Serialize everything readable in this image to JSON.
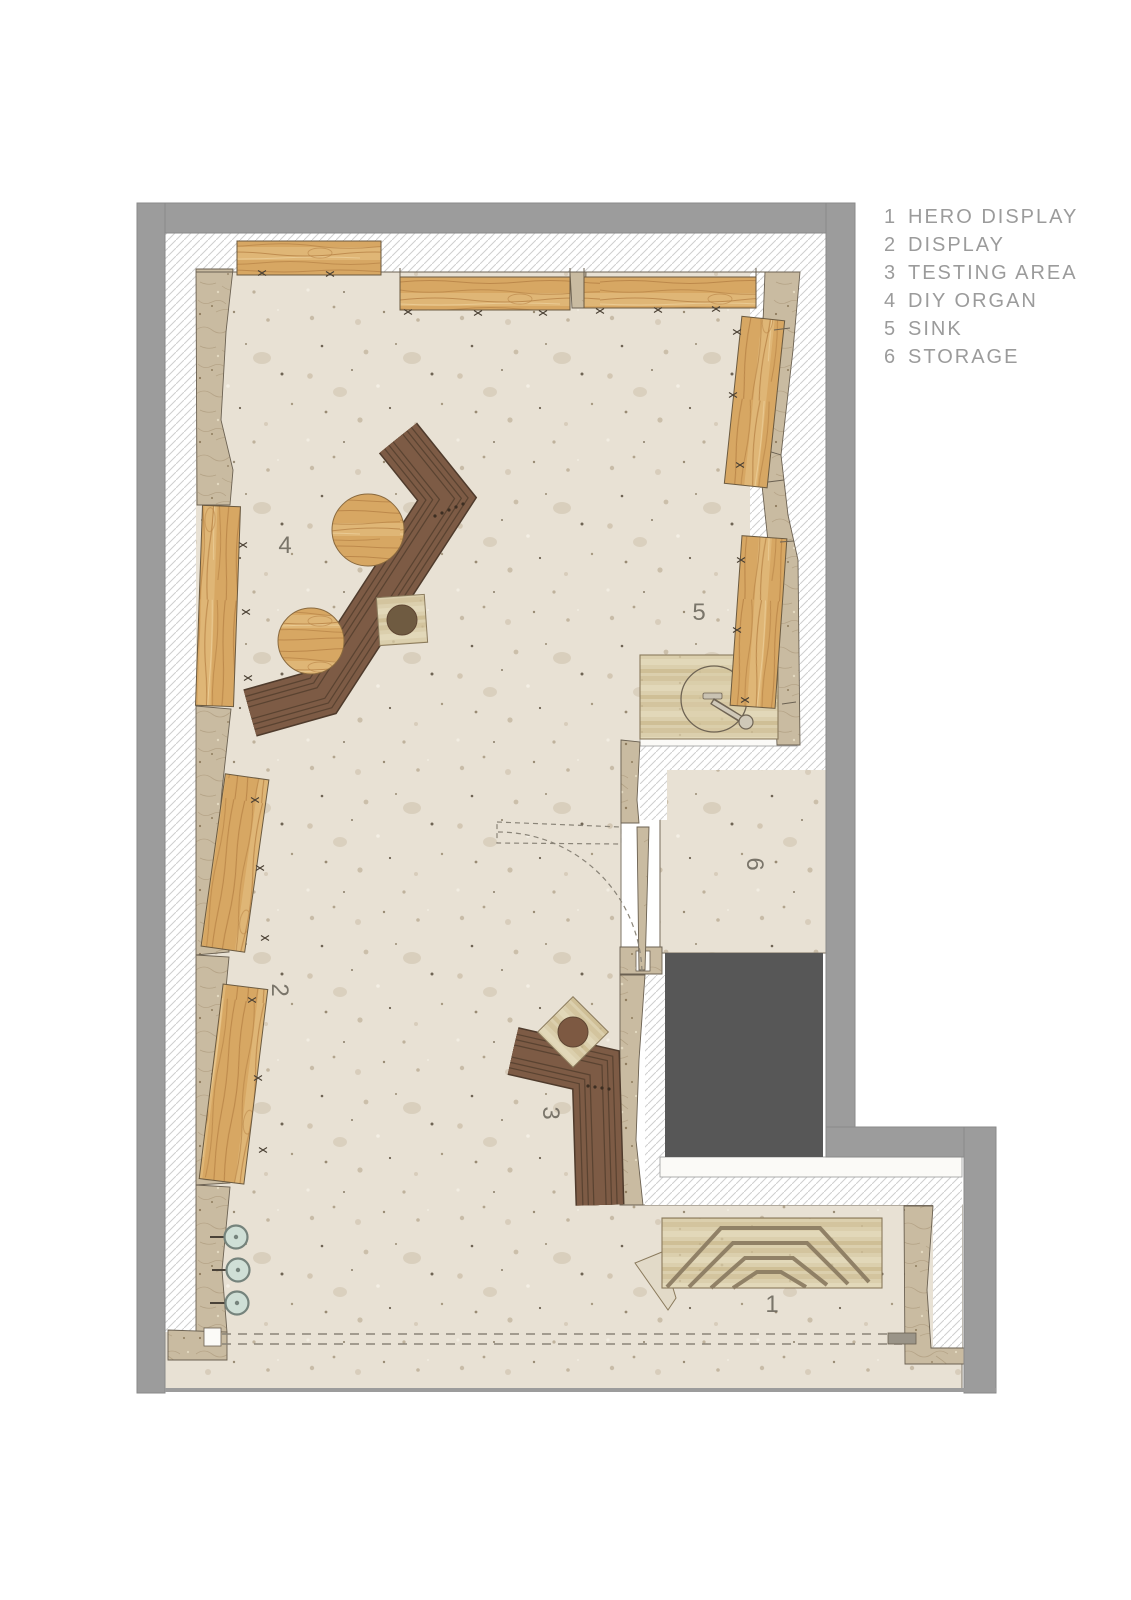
{
  "legend": {
    "items": [
      {
        "num": "1",
        "label": "HERO DISPLAY"
      },
      {
        "num": "2",
        "label": "DISPLAY"
      },
      {
        "num": "3",
        "label": "TESTING AREA"
      },
      {
        "num": "4",
        "label": "DIY ORGAN"
      },
      {
        "num": "5",
        "label": "SINK"
      },
      {
        "num": "6",
        "label": "STORAGE"
      }
    ]
  },
  "plan": {
    "labels": [
      {
        "text": "1",
        "area": "hero display"
      },
      {
        "text": "2",
        "area": "display"
      },
      {
        "text": "3",
        "area": "testing area"
      },
      {
        "text": "4",
        "area": "diy organ"
      },
      {
        "text": "5",
        "area": "sink"
      },
      {
        "text": "6",
        "area": "storage"
      }
    ]
  },
  "colors": {
    "wall_gray": "#9c9c9c",
    "void_dark": "#575757",
    "floor_beige": "#e8e1d4",
    "plaster_tan": "#c9bba1",
    "wood": "#d7a763",
    "counter_brown": "#7d5b45",
    "travertine": "#dbcfad",
    "mint_fixture": "#cfdfd6",
    "hatch_line": "#cfcfcf",
    "legend_text": "#9b9b9b"
  }
}
